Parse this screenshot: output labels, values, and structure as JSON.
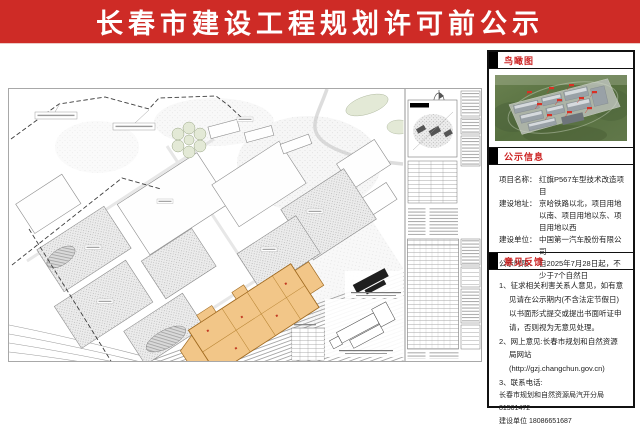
{
  "banner": {
    "title": "长春市建设工程规划许可前公示"
  },
  "colors": {
    "banner_red": "#ce2b26",
    "section_title_red": "#cc2222",
    "project_highlight_orange": "#f2c688"
  },
  "sidebar": {
    "birdseye": {
      "title": "鸟瞰图"
    },
    "notice": {
      "title": "公示信息",
      "fields": [
        {
          "label": "项目名称：",
          "value": "红旗P567车型技术改造项目"
        },
        {
          "label": "建设地址：",
          "value": "京哈铁路以北，项目用地以南、项目用地以东、项目用地以西"
        },
        {
          "label": "建设单位：",
          "value": "中国第一汽车股份有限公司"
        },
        {
          "label": "公示时限：",
          "value": "自2025年7月28日起，不少于7个自然日"
        }
      ]
    },
    "feedback": {
      "title": "意见反馈",
      "item1": "1、征求相关利害关系人意见，如有意见请在公示期内(不含法定节假日)以书面形式提交或提出书面听证申请，否则视为无意见处理。",
      "item2": "2、网上意见:长春市规划和自然资源局网站(http://gzj.changchun.gov.cn)",
      "item3": "3、联系电话:",
      "item3_line1": "长春市规划和自然资源局汽开分局81501472",
      "item3_line2": "建设单位 18086651687"
    }
  }
}
